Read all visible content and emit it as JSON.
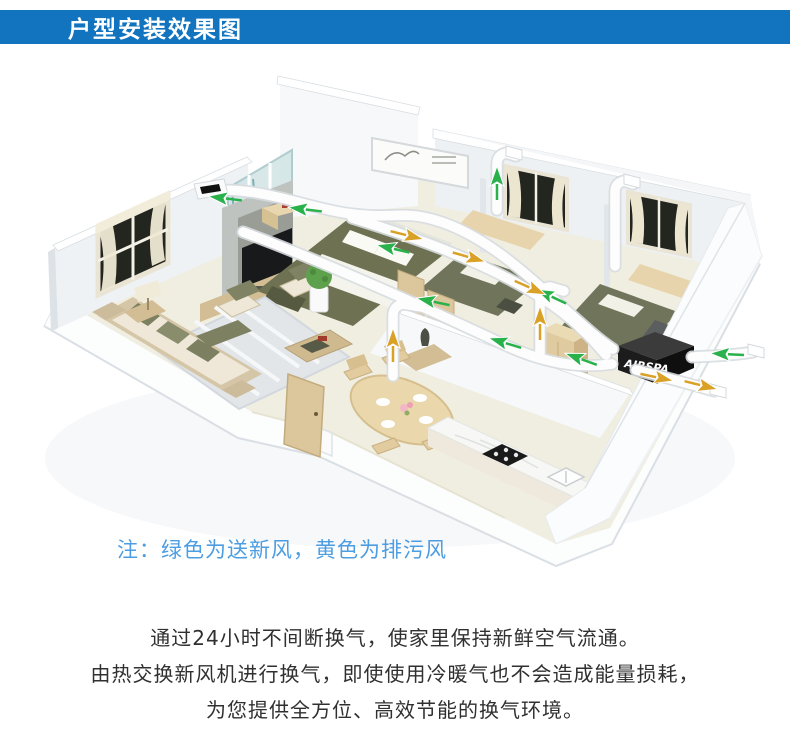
{
  "header": {
    "title": "户型安装效果图"
  },
  "palette": {
    "header_bg": "#1274bf",
    "note_blue": "#4d9de2",
    "text_dark": "#303030",
    "supply_green": "#29b14b",
    "exhaust_yellow": "#d9a125",
    "duct_white": "#fdfdfd",
    "wall_white": "#f3f5f7",
    "floor_cream": "#f0eee1",
    "wood_light": "#ddc89e",
    "olive_green": "#6e7254"
  },
  "diagram": {
    "note": "注：绿色为送新风，黄色为排污风",
    "unit_label": "AIRSPA",
    "arrows": {
      "supply": [
        [
          222,
          140,
          187
        ],
        [
          302,
          151,
          187
        ],
        [
          390,
          190,
          193
        ],
        [
          430,
          243,
          192
        ],
        [
          502,
          284,
          197
        ],
        [
          548,
          237,
          205
        ],
        [
          578,
          300,
          200
        ],
        [
          497,
          122,
          -90
        ],
        [
          724,
          296,
          183
        ]
      ],
      "exhaust": [
        [
          410,
          178,
          14
        ],
        [
          472,
          200,
          16
        ],
        [
          533,
          231,
          24
        ],
        [
          393,
          284,
          -90
        ],
        [
          540,
          262,
          -90
        ],
        [
          660,
          320,
          12
        ],
        [
          704,
          328,
          14
        ]
      ]
    }
  },
  "description": {
    "lines": [
      "通过24小时不间断换气，使家里保持新鲜空气流通。",
      "由热交换新风机进行换气，即使使用冷暖气也不会造成能量损耗，",
      "为您提供全方位、高效节能的换气环境。"
    ]
  }
}
